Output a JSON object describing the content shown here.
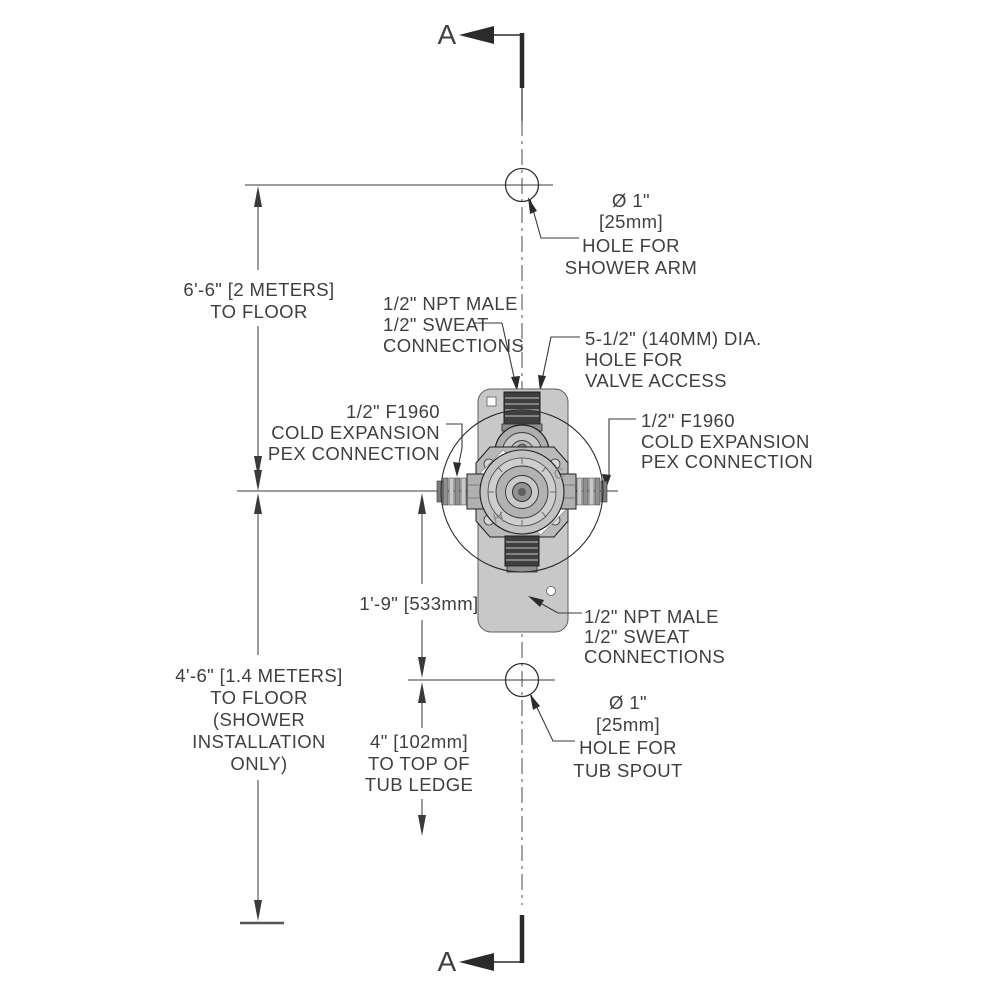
{
  "section_markers": {
    "top": "A",
    "bottom": "A"
  },
  "dimensions": {
    "shower_arm_to_floor": {
      "lines": [
        "6'-6\" [2 METERS]",
        "TO FLOOR"
      ]
    },
    "valve_center_to_floor": {
      "lines": [
        "4'-6\" [1.4 METERS]",
        "TO FLOOR",
        "(SHOWER",
        "INSTALLATION",
        "ONLY)"
      ]
    },
    "valve_center_to_tub_spout": {
      "lines": [
        "1'-9\" [533mm]"
      ]
    },
    "tub_spout_to_tub_ledge": {
      "lines": [
        "4\" [102mm]",
        "TO TOP OF",
        "TUB LEDGE"
      ]
    }
  },
  "callouts": {
    "shower_arm_hole": {
      "lines": [
        "Ø 1\"",
        "[25mm]",
        "HOLE FOR",
        "SHOWER ARM"
      ]
    },
    "valve_access_hole": {
      "lines": [
        "5-1/2\" (140MM) DIA.",
        "HOLE FOR",
        "VALVE ACCESS"
      ]
    },
    "npt_connections_top": {
      "lines": [
        "1/2\" NPT MALE",
        "1/2\" SWEAT",
        "CONNECTIONS"
      ]
    },
    "pex_connection_left": {
      "lines": [
        "1/2\" F1960",
        "COLD EXPANSION",
        "PEX CONNECTION"
      ]
    },
    "pex_connection_right": {
      "lines": [
        "1/2\" F1960",
        "COLD EXPANSION",
        "PEX CONNECTION"
      ]
    },
    "npt_connections_bottom": {
      "lines": [
        "1/2\" NPT MALE",
        "1/2\" SWEAT",
        "CONNECTIONS"
      ]
    },
    "tub_spout_hole": {
      "lines": [
        "Ø 1\"",
        "[25mm]",
        "HOLE FOR",
        "TUB SPOUT"
      ]
    }
  },
  "valve": {
    "hot_label": "H",
    "cold_label": "C"
  },
  "colors": {
    "line": "#3a3a3a",
    "text": "#3f3f3f",
    "bracket": "#c8c8c8",
    "metal_dark": "#3f3f3f",
    "metal_light": "#c2c2c2"
  }
}
